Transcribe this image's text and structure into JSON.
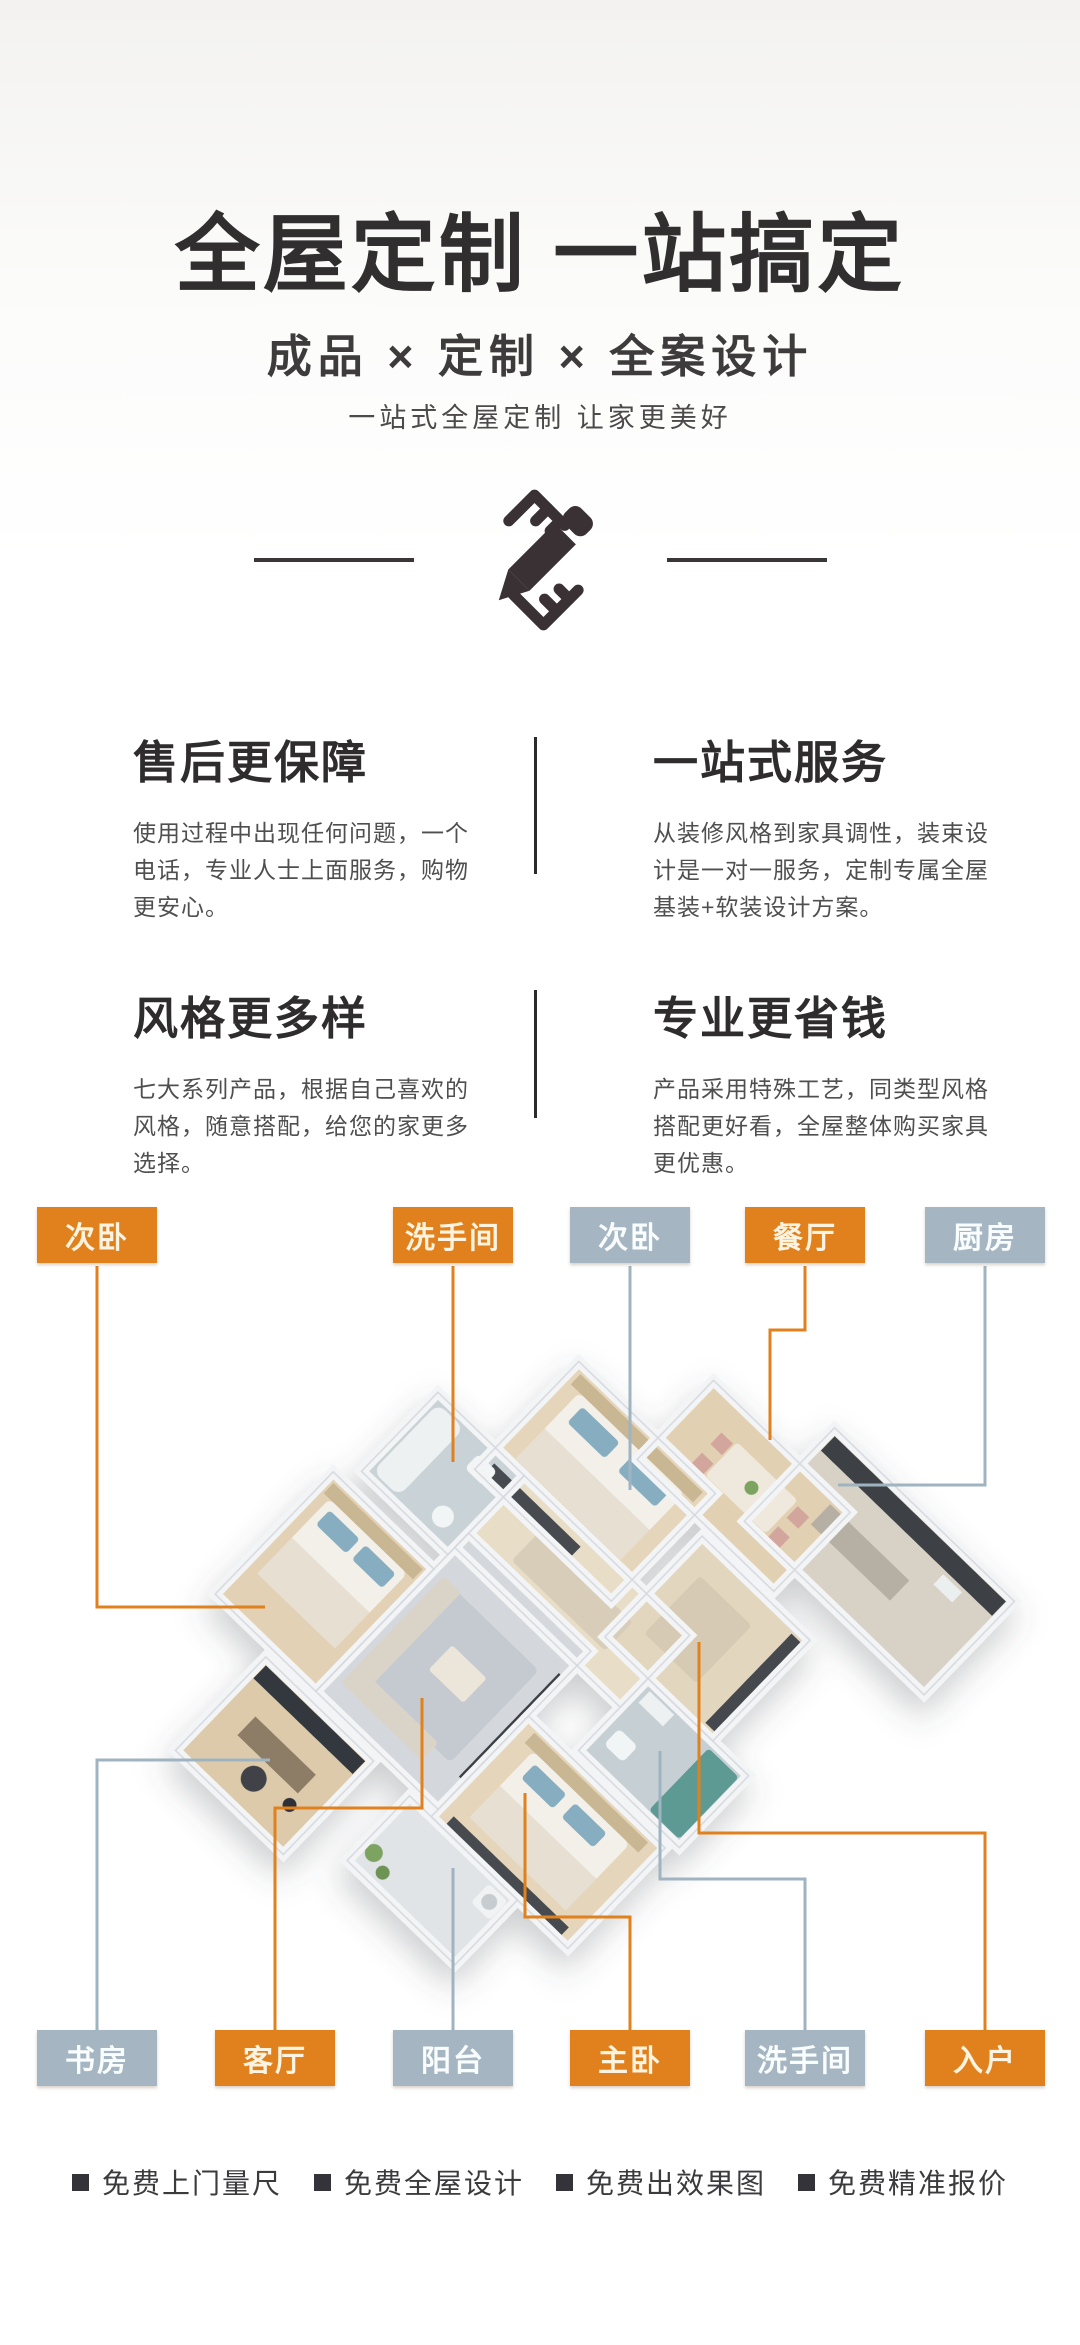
{
  "header": {
    "title": "全屋定制 一站搞定",
    "subtitle": "成品 × 定制 × 全案设计",
    "tagline": "一站式全屋定制 让家更美好",
    "icon": "pencil-ruler-icon"
  },
  "features": [
    {
      "title": "售后更保障",
      "desc": "使用过程中出现任何问题，一个电话，专业人士上面服务，购物更安心。"
    },
    {
      "title": "一站式服务",
      "desc": "从装修风格到家具调性，装束设计是一对一服务，定制专属全屋基装+软装设计方案。"
    },
    {
      "title": "风格更多样",
      "desc": "七大系列产品，根据自己喜欢的风格，随意搭配，给您的家更多选择。"
    },
    {
      "title": "专业更省钱",
      "desc": "产品采用特殊工艺，同类型风格搭配更好看，全屋整体购买家具更优惠。"
    }
  ],
  "floorplan": {
    "labels_top": [
      {
        "label": "次卧",
        "variant": "orange"
      },
      {
        "label": "洗手间",
        "variant": "orange"
      },
      {
        "label": "次卧",
        "variant": "gray_blue"
      },
      {
        "label": "餐厅",
        "variant": "orange"
      },
      {
        "label": "厨房",
        "variant": "gray_blue"
      }
    ],
    "labels_bottom": [
      {
        "label": "书房",
        "variant": "gray_blue"
      },
      {
        "label": "客厅",
        "variant": "orange"
      },
      {
        "label": "阳台",
        "variant": "gray_blue"
      },
      {
        "label": "主卧",
        "variant": "orange"
      },
      {
        "label": "洗手间",
        "variant": "gray_blue"
      },
      {
        "label": "入户",
        "variant": "orange"
      }
    ]
  },
  "footer": {
    "bullets": [
      "免费上门量尺",
      "免费全屋设计",
      "免费出效果图",
      "免费精准报价"
    ]
  },
  "colors": {
    "orange": "#e0811d",
    "gray_blue": "#a5b6c2",
    "line_orange": "#e0811d",
    "line_gray": "#9fb4c0"
  }
}
